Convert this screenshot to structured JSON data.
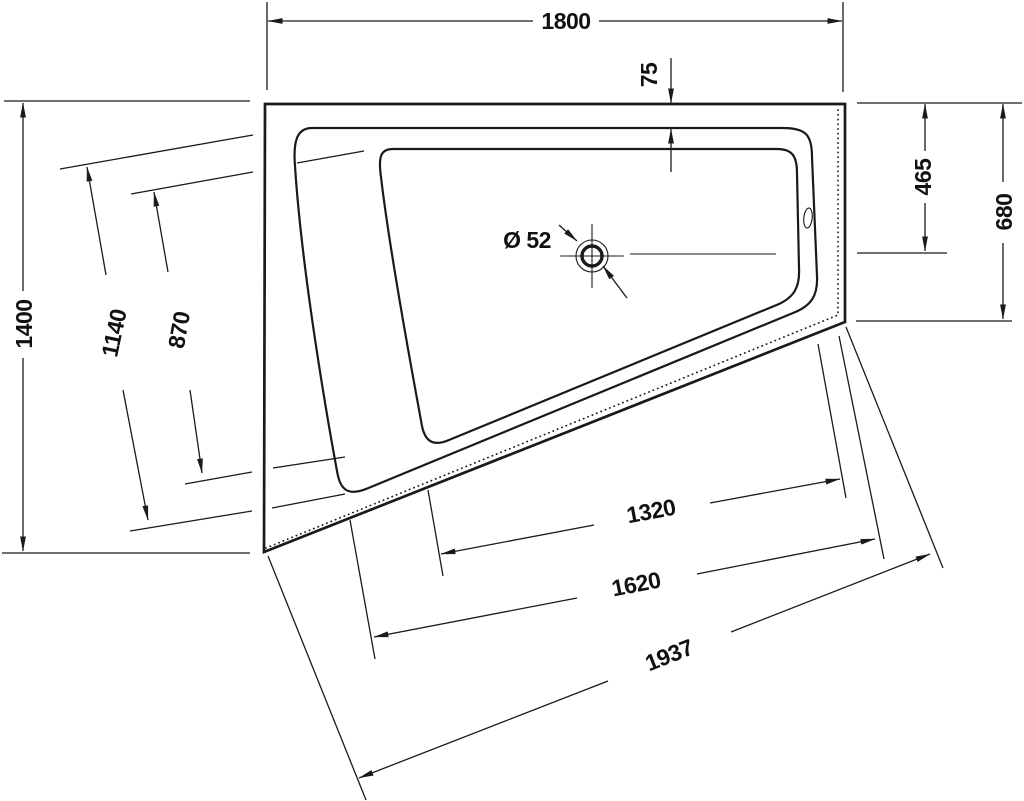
{
  "drawing": {
    "description": "Corner bathtub technical dimension drawing, plan view",
    "background": "#ffffff",
    "line_color": "#1a1a1a",
    "units": "mm",
    "dims": {
      "top_width": "1800",
      "rim_inset": "75",
      "left_height": "1400",
      "diag_outer": "1140",
      "diag_inner": "870",
      "right_upper": "465",
      "right_full": "680",
      "bottom_inner": "1320",
      "bottom_mid": "1620",
      "bottom_diag": "1937",
      "drain_diameter": "Ø 52"
    }
  }
}
